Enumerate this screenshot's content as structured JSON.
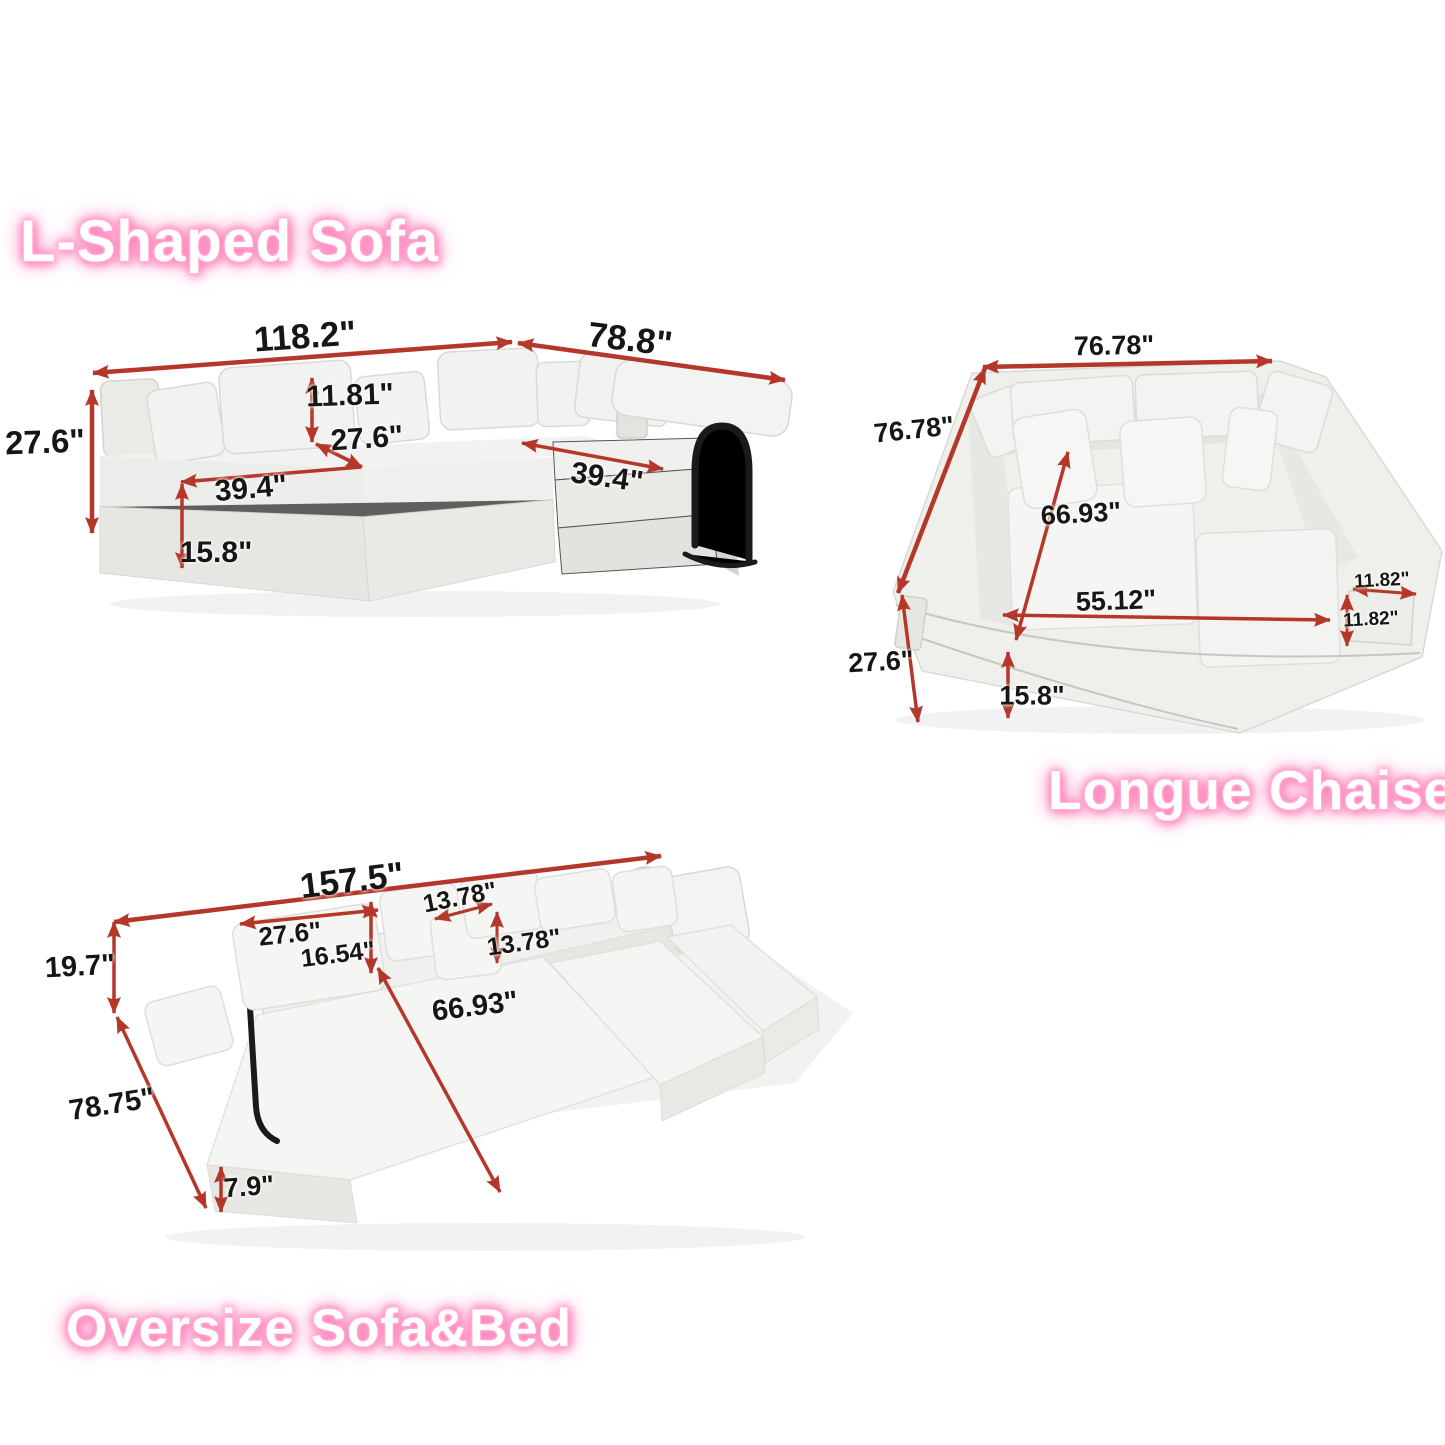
{
  "page": {
    "background": "#ffffff"
  },
  "colors": {
    "arrow_red": "#b5372a",
    "dimension_text": "#161616",
    "title_text": "#ffffff",
    "title_glow": "#ff74b2",
    "sofa_fabric_light": "#f2f2f0",
    "sofa_fabric_shade": "#e6e6e3",
    "handle_black": "#1a1a1a"
  },
  "sections": {
    "l_shaped_sofa": {
      "title": "L-Shaped Sofa",
      "dimensions": {
        "total_width": "118.2\"",
        "chaise_length": "78.8\"",
        "overall_height": "27.6\"",
        "back_cushion_height": "11.81\"",
        "seat_depth": "27.6\"",
        "seat_width": "39.4\"",
        "chaise_seat_width": "39.4\"",
        "base_height": "15.8\""
      }
    },
    "longue_chaise": {
      "title": "Longue Chaise",
      "dimensions": {
        "total_width": "76.78\"",
        "total_depth": "76.78\"",
        "inner_diagonal": "66.93\"",
        "inner_width": "55.12\"",
        "armrest_width": "11.82\"",
        "armrest_height": "11.82\"",
        "overall_height": "27.6\"",
        "base_height": "15.8\""
      }
    },
    "oversize_sofa_bed": {
      "title": "Oversize Sofa&Bed",
      "dimensions": {
        "total_length": "157.5\"",
        "back_cushion_width": "27.6\"",
        "back_cushion_height": "16.54\"",
        "pillow_width": "13.78\"",
        "pillow_height": "13.78\"",
        "back_height": "19.7\"",
        "bed_diagonal": "66.93\"",
        "total_depth": "78.75\"",
        "mattress_height": "7.9\""
      }
    }
  }
}
